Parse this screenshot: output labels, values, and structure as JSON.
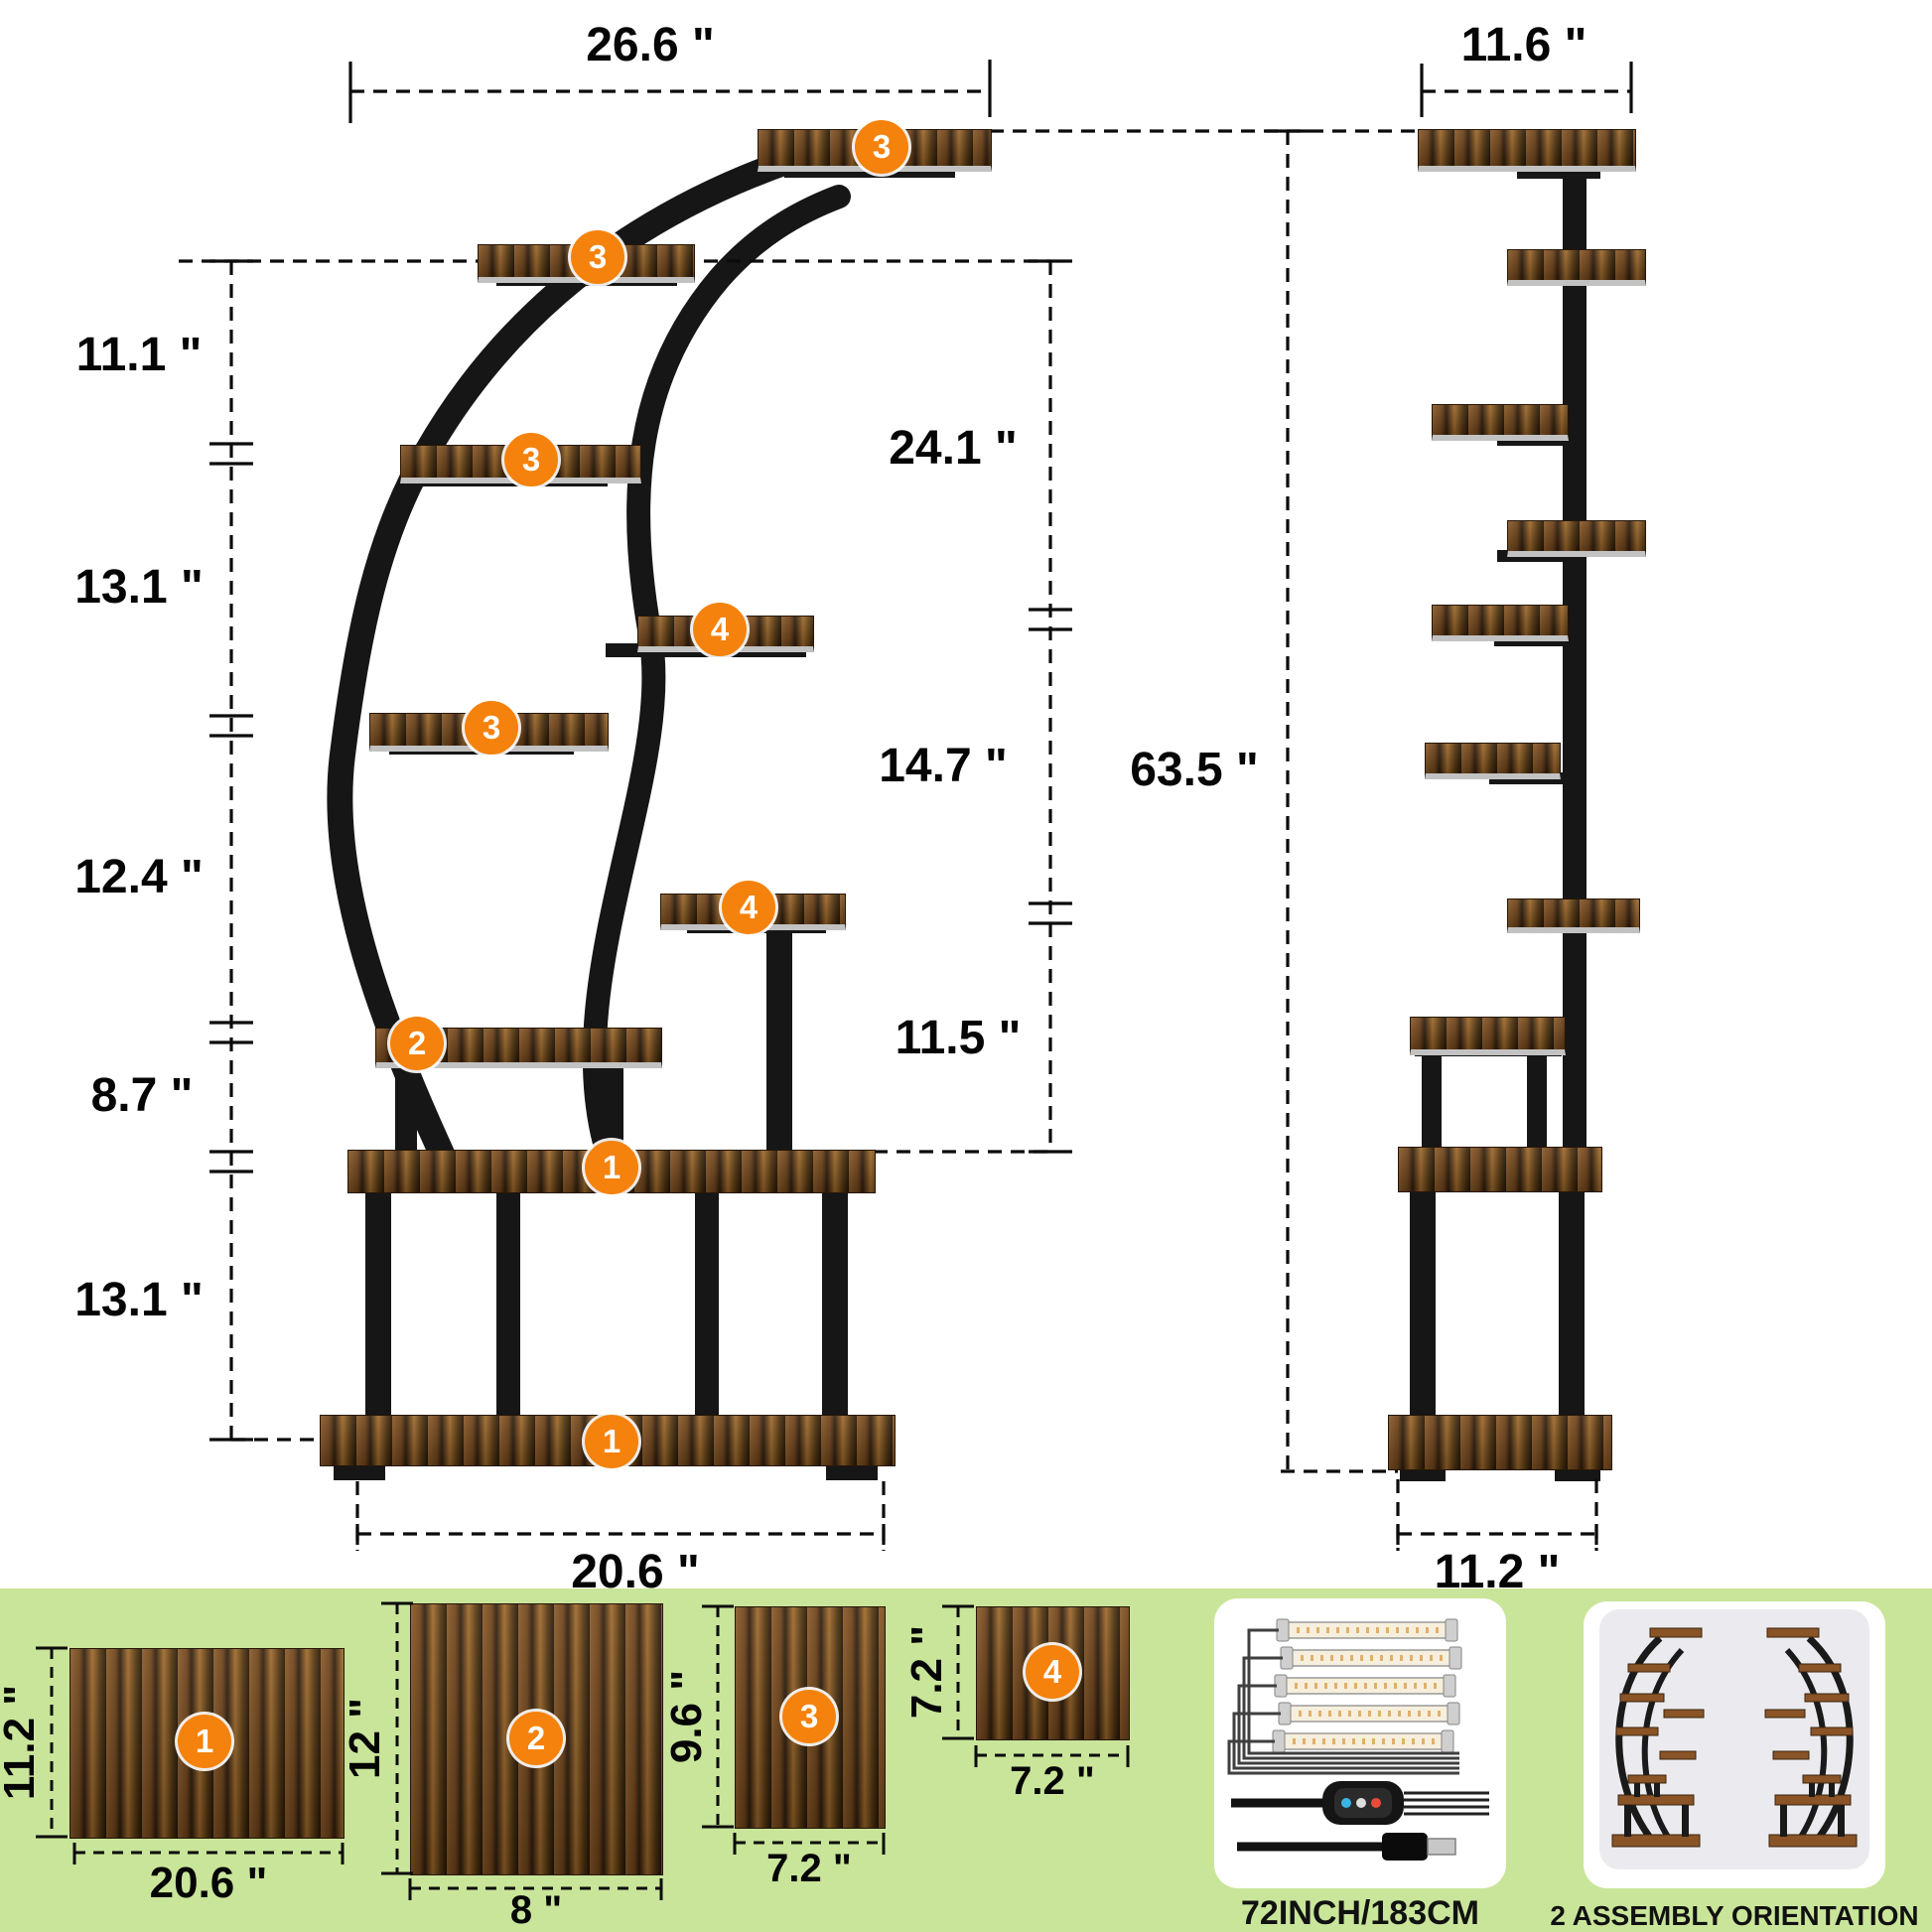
{
  "front": {
    "top_width": "26.6 \"",
    "bottom_width": "20.6 \"",
    "left_heights": [
      "11.1 \"",
      "13.1 \"",
      "12.4 \"",
      "8.7 \"",
      "13.1 \""
    ],
    "right_heights": [
      "24.1 \"",
      "14.7 \"",
      "11.5 \""
    ],
    "total_height": "63.5 \"",
    "shelf_badges": [
      "3",
      "3",
      "3",
      "4",
      "3",
      "4",
      "2",
      "1",
      "1"
    ]
  },
  "side": {
    "top_width": "11.6 \"",
    "bottom_width": "11.2 \""
  },
  "panels": [
    {
      "num": "1",
      "width_label": "20.6 \"",
      "height_label": "11.2 \""
    },
    {
      "num": "2",
      "width_label": "8 \"",
      "height_label": "12 \""
    },
    {
      "num": "3",
      "width_label": "7.2 \"",
      "height_label": "9.6 \""
    },
    {
      "num": "4",
      "width_label": "7.2 \"",
      "height_label": "7.2 \""
    }
  ],
  "footer": {
    "led_caption": "72INCH/183CM",
    "assembly_caption": "2 ASSEMBLY ORIENTATION"
  },
  "colors": {
    "badge_orange": "#F5820C",
    "strip_green": "#C9E59A",
    "wood_brown": "#7A4B1E",
    "metal_black": "#161616"
  }
}
